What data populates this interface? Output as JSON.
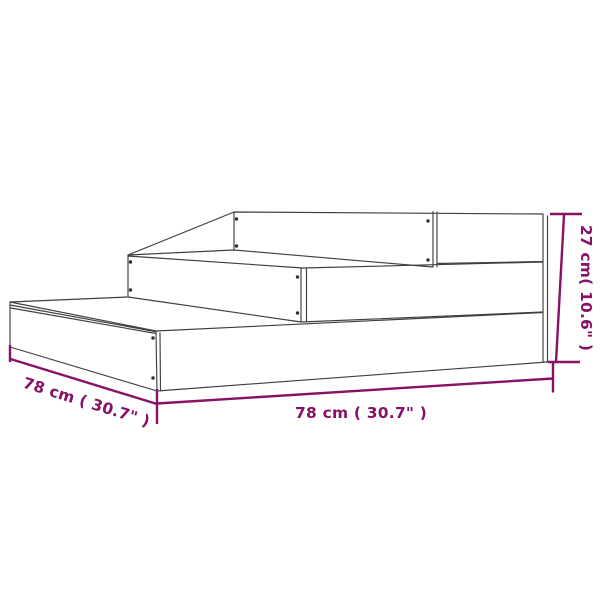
{
  "diagram": {
    "background_color": "#ffffff",
    "line_color": "#3f3f3f",
    "screw_color": "#303030",
    "accent_color": "#871166",
    "subject": "3-tier stepped planter line drawing",
    "dimensions": {
      "depth": {
        "label": "78 cm ( 30.7\" )",
        "value_cm": 78,
        "value_in": 30.7
      },
      "width": {
        "label": "78 cm ( 30.7\" )",
        "value_cm": 78,
        "value_in": 30.7
      },
      "height": {
        "label": "27 cm( 10.6\" )",
        "value_cm": 27,
        "value_in": 10.6
      }
    }
  }
}
